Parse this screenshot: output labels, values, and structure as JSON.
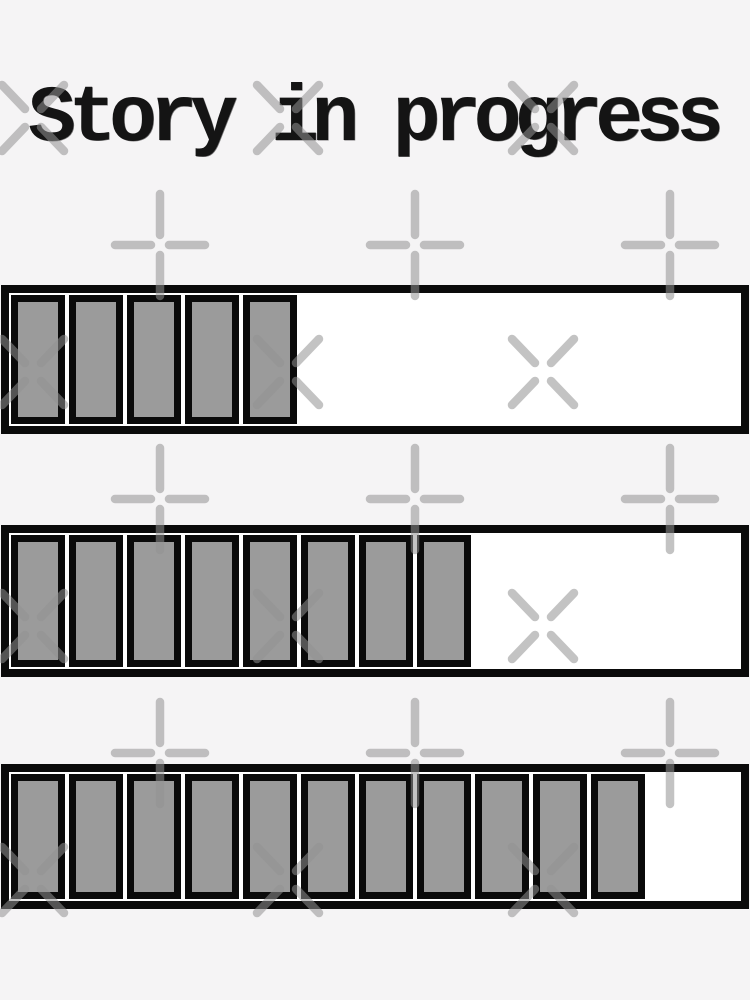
{
  "title": "Story in progress",
  "progress_bars": [
    {
      "label": "progress-bar-top",
      "filled_segments": 5
    },
    {
      "label": "progress-bar-middle",
      "filled_segments": 8
    },
    {
      "label": "progress-bar-bottom",
      "filled_segments": 11
    }
  ],
  "colors": {
    "background": "#f5f4f5",
    "bar_fill": "#ffffff",
    "outline": "#0a0a0a",
    "segment_fill": "#9b9b9b",
    "title_text": "#141414",
    "watermark": "#919191"
  }
}
